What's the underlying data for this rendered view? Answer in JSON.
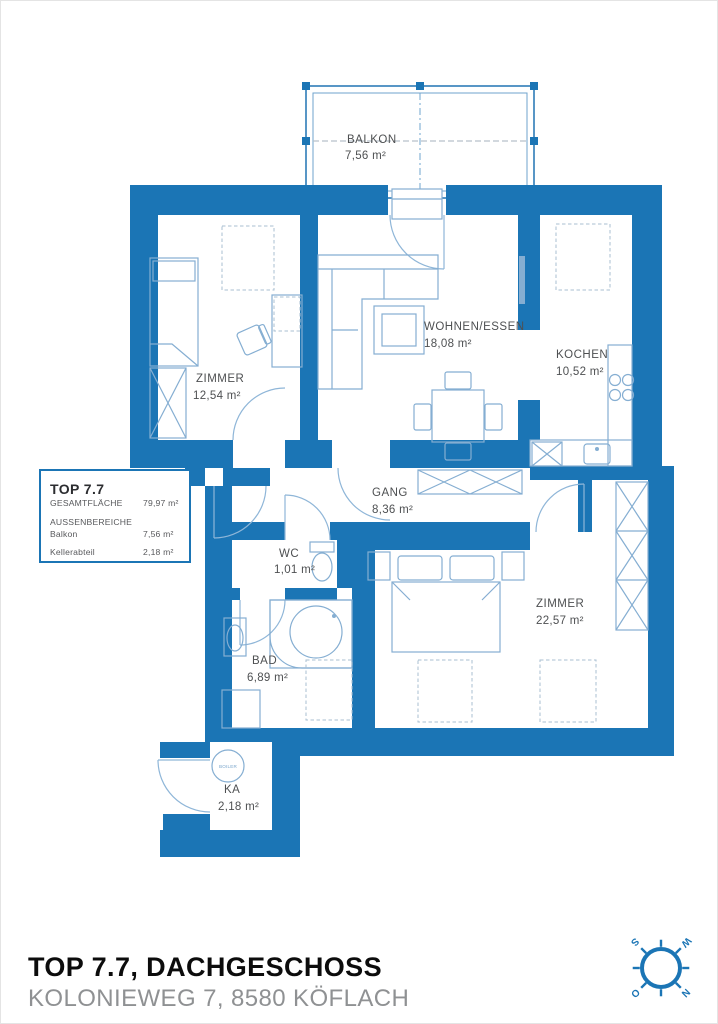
{
  "plan": {
    "balcony": {
      "name": "BALKON",
      "area": "7,56 m²"
    },
    "rooms": [
      {
        "id": "zimmer-left",
        "name": "ZIMMER",
        "area": "12,54 m²"
      },
      {
        "id": "wohnen-essen",
        "name": "WOHNEN/ESSEN",
        "area": "18,08 m²"
      },
      {
        "id": "kochen",
        "name": "KOCHEN",
        "area": "10,52 m²"
      },
      {
        "id": "gang",
        "name": "GANG",
        "area": "8,36 m²"
      },
      {
        "id": "wc",
        "name": "WC",
        "area": "1,01 m²"
      },
      {
        "id": "bad",
        "name": "BAD",
        "area": "6,89 m²"
      },
      {
        "id": "zimmer-right",
        "name": "ZIMMER",
        "area": "22,57 m²"
      },
      {
        "id": "ka",
        "name": "KA",
        "area": "2,18 m²"
      }
    ],
    "boiler_label": "BOILER"
  },
  "info_box": {
    "title": "TOP 7.7",
    "total_label": "GESAMTFLÄCHE",
    "total_value": "79,97 m²",
    "outdoor_label": "AUSSENBEREICHE",
    "balcony_label": "Balkon",
    "balcony_value": "7,56 m²",
    "cellar_label": "Kellerabteil",
    "cellar_value": "2,18 m²"
  },
  "footer": {
    "title": "TOP 7.7, DACHGESCHOSS",
    "subtitle": "KOLONIEWEG 7, 8580 KÖFLACH"
  },
  "compass": {
    "north": "N",
    "east": "O",
    "south": "S",
    "west": "W"
  },
  "colors": {
    "wall": "#1b75b5",
    "furniture_line": "#85aed2",
    "dashed_line": "#a9bfd2",
    "label_text": "#4e5052",
    "footer_title": "#0c0c0c",
    "footer_subtitle": "#8f9193"
  }
}
